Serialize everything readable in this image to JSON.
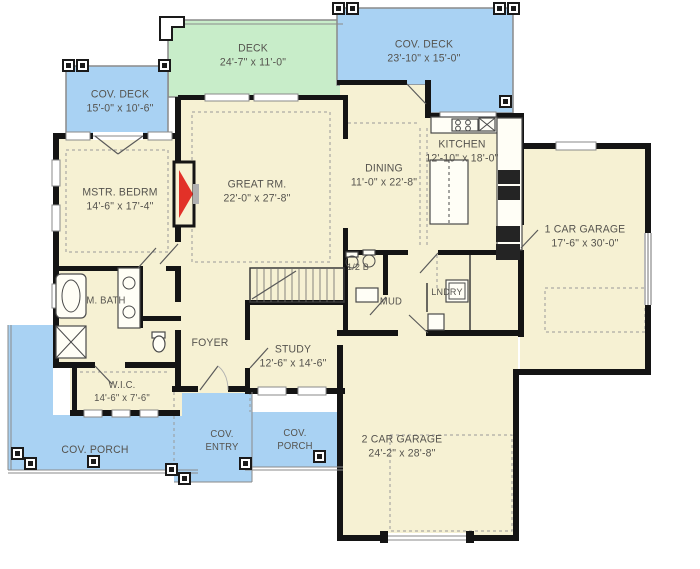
{
  "colors": {
    "deck_green": "#c8edc9",
    "porch_blue": "#a9d2f3",
    "floor_cream": "#f6f1d3",
    "wall": "#141414",
    "line_gray": "#999999",
    "fireplace_red": "#e23128"
  },
  "rooms": {
    "deck": {
      "line1": "DECK",
      "line2": "24'-7\" x 11'-0\""
    },
    "cov_deck_right": {
      "line1": "COV. DECK",
      "line2": "23'-10\" x 15'-0\""
    },
    "cov_deck_left": {
      "line1": "COV. DECK",
      "line2": "15'-0\" x 10'-6\""
    },
    "master": {
      "line1": "MSTR. BEDRM",
      "line2": "14'-6\" x 17'-4\""
    },
    "great": {
      "line1": "GREAT RM.",
      "line2": "22'-0\" x 27'-8\""
    },
    "dining": {
      "line1": "DINING",
      "line2": "11'-0\" x 22'-8\""
    },
    "kitchen": {
      "line1": "KITCHEN",
      "line2": "12'-10\" x 18'-0\""
    },
    "garage1": {
      "line1": "1 CAR GARAGE",
      "line2": "17'-6\" x 30'-0\""
    },
    "mbath": {
      "line1": "M. BATH",
      "line2": ""
    },
    "wic": {
      "line1": "W.I.C.",
      "line2": "14'-6\" x 7'-6\""
    },
    "foyer": {
      "line1": "FOYER",
      "line2": ""
    },
    "study": {
      "line1": "STUDY",
      "line2": "12'-6\" x 14'-6\""
    },
    "half_bath": {
      "line1": "1/2 B",
      "line2": ""
    },
    "mud": {
      "line1": "MUD",
      "line2": ""
    },
    "laundry": {
      "line1": "LNDRY",
      "line2": ""
    },
    "porch_left": {
      "line1": "COV. PORCH",
      "line2": ""
    },
    "entry": {
      "line1": "COV.",
      "line2": "ENTRY"
    },
    "porch_center": {
      "line1": "COV.",
      "line2": "PORCH"
    },
    "garage2": {
      "line1": "2 CAR GARAGE",
      "line2": "24'-2\" x 28'-8\""
    }
  }
}
